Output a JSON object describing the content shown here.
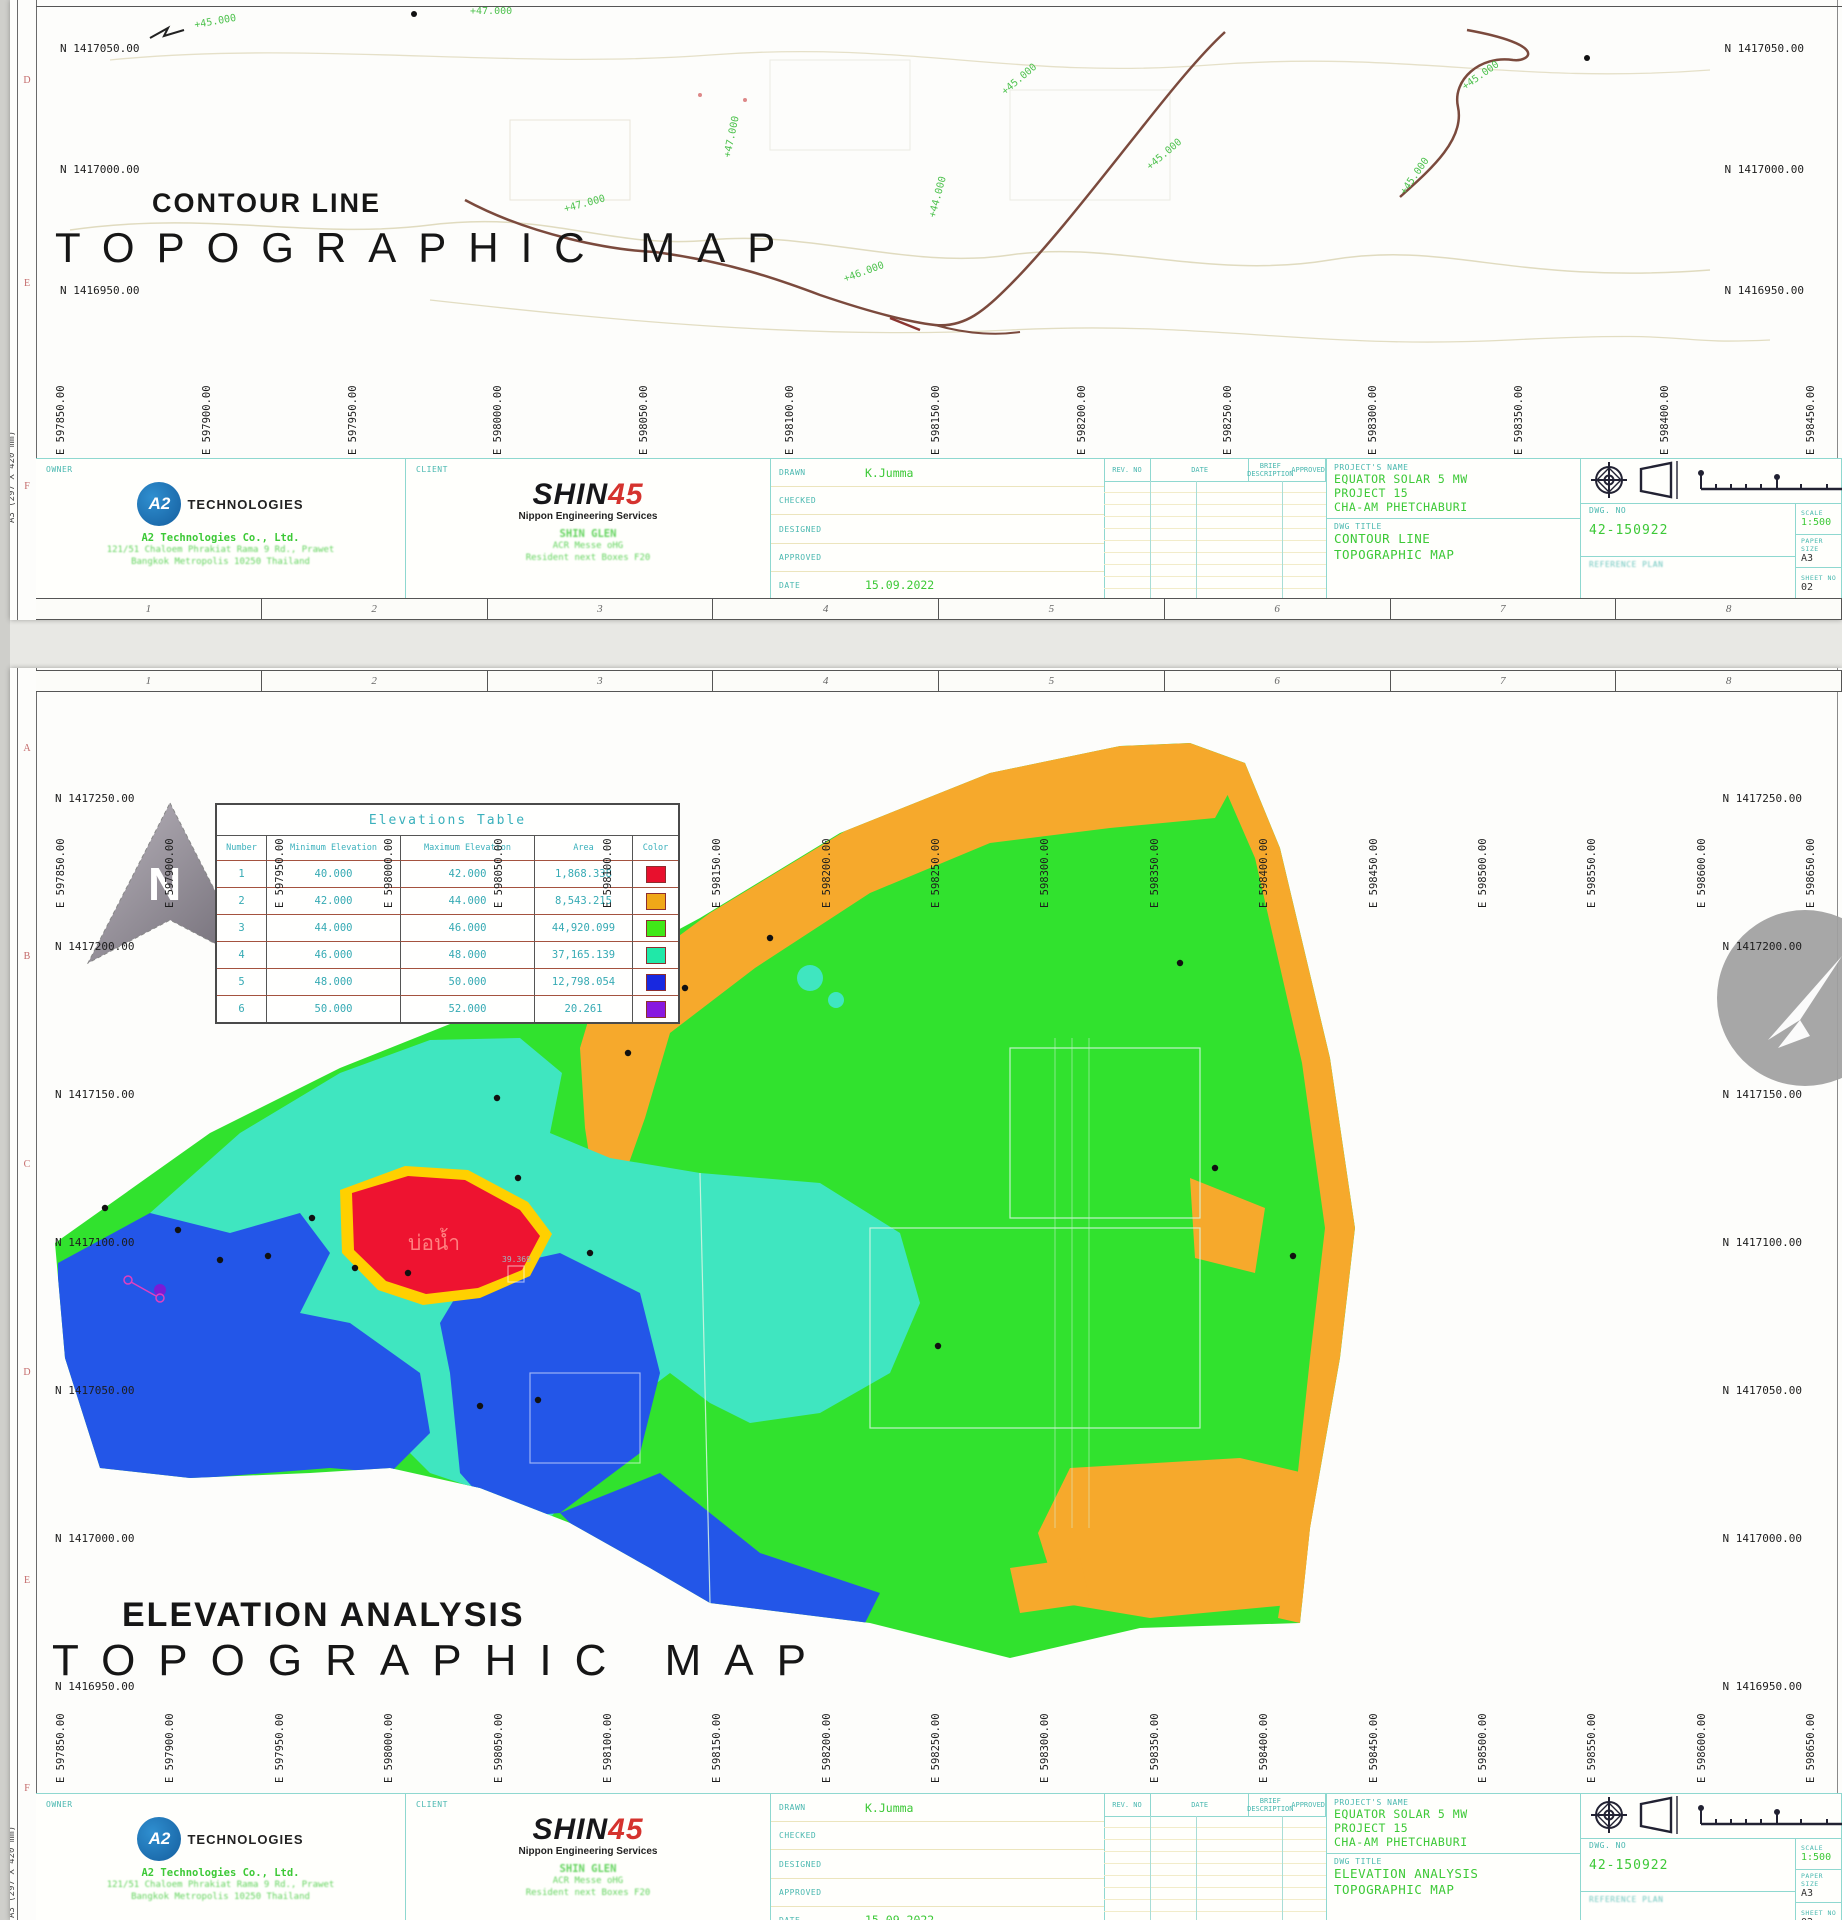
{
  "page": {
    "paper_note": "A3  (297 X 420 mm)"
  },
  "colors": {
    "accent_teal": "#4ab8b0",
    "cad_green": "#3dc937",
    "shin_red": "#d5332e",
    "a2_blue": "#1c72b8",
    "map_green": "#31e22e",
    "map_turquoise": "#3fe6c0",
    "map_blue": "#2356e8",
    "map_orange": "#f6a92c",
    "map_red": "#ee1330",
    "map_purple": "#7a1bd6"
  },
  "ruler_numbers": [
    "1",
    "2",
    "3",
    "4",
    "5",
    "6",
    "7",
    "8"
  ],
  "top_sheet": {
    "row_letters": [
      "D",
      "E",
      "F"
    ],
    "title_small": "CONTOUR LINE",
    "title_large": "TOPOGRAPHIC MAP",
    "n_left": [
      "N 1417050.00",
      "N 1417000.00",
      "N 1416950.00"
    ],
    "n_right": [
      "N 1417050.00",
      "N 1417000.00",
      "N 1416950.00"
    ],
    "e_labels": [
      "E 597850.00",
      "E 597900.00",
      "E 597950.00",
      "E 598000.00",
      "E 598050.00",
      "E 598100.00",
      "E 598150.00",
      "E 598200.00",
      "E 598250.00",
      "E 598300.00",
      "E 598350.00",
      "E 598400.00",
      "E 598450.00"
    ],
    "contour_labels": [
      "+45.000",
      "+47.000",
      "+47.000",
      "+44.000",
      "+45.000",
      "+45.000",
      "+45.000",
      "+45.000",
      "+46.000",
      "+47.000"
    ]
  },
  "bottom_sheet": {
    "row_letters": [
      "A",
      "B",
      "C",
      "D",
      "E",
      "F"
    ],
    "title_small": "ELEVATION ANALYSIS",
    "title_large": "TOPOGRAPHIC MAP",
    "north_letter": "N",
    "pond_label": "บ่อน้ำ",
    "point_label": "39.369",
    "n_left": [
      "N 1417250.00",
      "N 1417200.00",
      "N 1417150.00",
      "N 1417100.00",
      "N 1417050.00",
      "N 1417000.00",
      "N 1416950.00"
    ],
    "n_right": [
      "N 1417250.00",
      "N 1417200.00",
      "N 1417150.00",
      "N 1417100.00",
      "N 1417050.00",
      "N 1417000.00",
      "N 1416950.00"
    ],
    "e_labels_top": [
      "E 597850.00",
      "E 597900.00",
      "E 597950.00",
      "E 598000.00",
      "E 598050.00",
      "E 598100.00",
      "E 598150.00",
      "E 598200.00",
      "E 598250.00",
      "E 598300.00",
      "E 598350.00",
      "E 598400.00",
      "E 598450.00",
      "E 598500.00",
      "E 598550.00",
      "E 598600.00",
      "E 598650.00"
    ],
    "e_labels_bottom": [
      "E 597850.00",
      "E 597900.00",
      "E 597950.00",
      "E 598000.00",
      "E 598050.00",
      "E 598100.00",
      "E 598150.00",
      "E 598200.00",
      "E 598250.00",
      "E 598300.00",
      "E 598350.00",
      "E 598400.00",
      "E 598450.00",
      "E 598500.00",
      "E 598550.00",
      "E 598600.00",
      "E 598650.00"
    ],
    "elevations_table": {
      "title": "Elevations Table",
      "columns": [
        "Number",
        "Minimum Elevation",
        "Maximum Elevation",
        "Area",
        "Color"
      ],
      "rows": [
        {
          "number": "1",
          "min": "40.000",
          "max": "42.000",
          "area": "1,868.338",
          "color": "#e8102d"
        },
        {
          "number": "2",
          "min": "42.000",
          "max": "44.000",
          "area": "8,543.215",
          "color": "#f0a818"
        },
        {
          "number": "3",
          "min": "44.000",
          "max": "46.000",
          "area": "44,920.099",
          "color": "#40e818"
        },
        {
          "number": "4",
          "min": "46.000",
          "max": "48.000",
          "area": "37,165.139",
          "color": "#20e8a8"
        },
        {
          "number": "5",
          "min": "48.000",
          "max": "50.000",
          "area": "12,798.054",
          "color": "#1828e0"
        },
        {
          "number": "6",
          "min": "50.000",
          "max": "52.000",
          "area": "20.261",
          "color": "#8818e0"
        }
      ]
    }
  },
  "title_block": {
    "owner_label": "OWNER",
    "client_label": "CLIENT",
    "a2_logo_text": "A2",
    "a2_name": "TECHNOLOGIES",
    "a2_company": "A2 Technologies Co., Ltd.",
    "a2_address1": "121/51 Chaloem Phrakiat Rama 9 Rd., Prawet",
    "a2_address2": "Bangkok Metropolis 10250 Thailand",
    "shin_black": "SHIN",
    "shin_red_text": "45",
    "shin_subtitle": "Nippon Engineering Services",
    "shin_line1": "SHIN GLEN",
    "shin_line2": "ACR Messe oHG",
    "shin_line3": "Resident next Boxes F20",
    "fields": [
      {
        "label": "DRAWN",
        "value": "K.Jumma"
      },
      {
        "label": "CHECKED",
        "value": ""
      },
      {
        "label": "DESIGNED",
        "value": ""
      },
      {
        "label": "APPROVED",
        "value": ""
      },
      {
        "label": "DATE",
        "value": "15.09.2022"
      }
    ],
    "rev_columns": [
      "REV. NO",
      "DATE",
      "BRIEF DESCRIPTION",
      "APPROVED"
    ],
    "project_label": "PROJECT'S NAME",
    "project_lines": [
      "EQUATOR SOLAR 5 MW",
      "PROJECT 15",
      "CHA-AM PHETCHABURI"
    ],
    "dwg_title_label": "DWG TITLE",
    "dwg_title_top_lines": [
      "CONTOUR LINE",
      "TOPOGRAPHIC MAP"
    ],
    "dwg_title_bottom_lines": [
      "ELEVATION ANALYSIS",
      "TOPOGRAPHIC MAP"
    ],
    "dwg_no_label": "DWG. NO",
    "dwg_no": "42-150922",
    "ref_label": "REFERENCE PLAN",
    "scale_label": "SCALE",
    "scale_value": "1:500",
    "paper_label": "PAPER SIZE",
    "paper_value": "A3",
    "sheet_label": "SHEET NO",
    "sheet_value": "02"
  }
}
